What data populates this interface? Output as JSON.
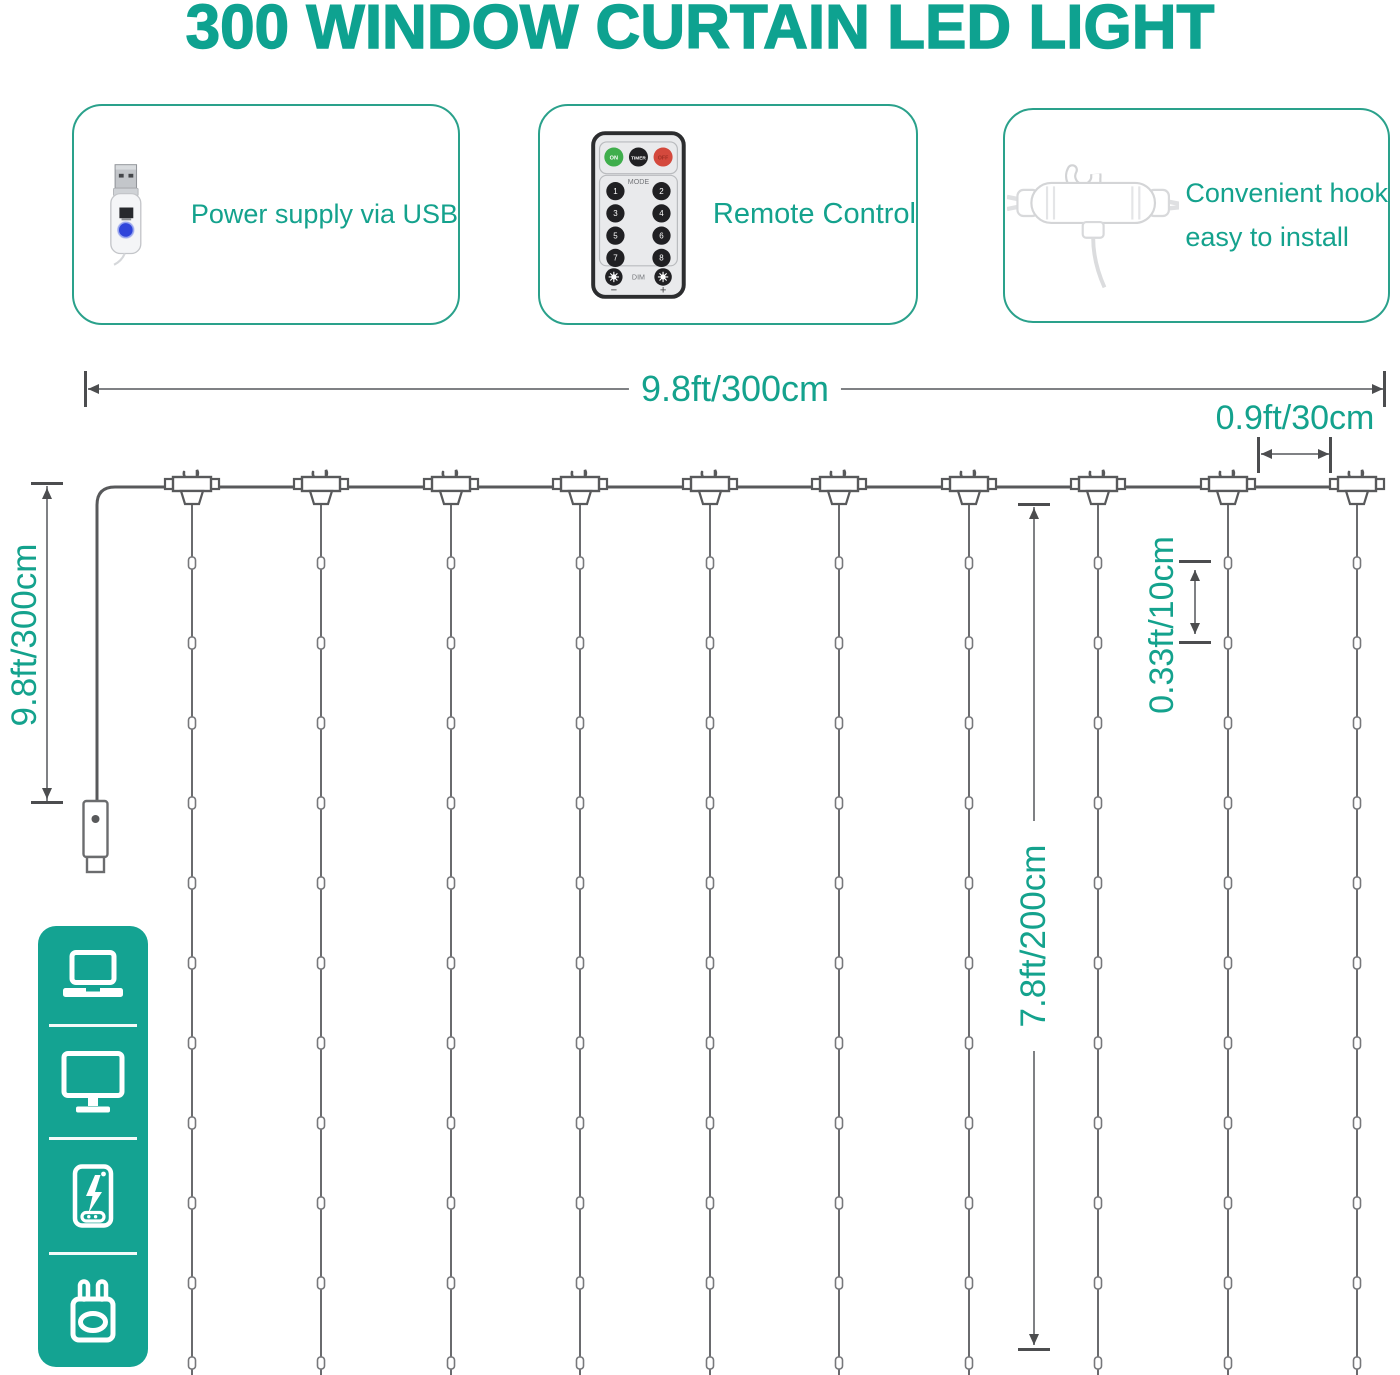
{
  "title": "300 WINDOW CURTAIN LED LIGHT",
  "theme": {
    "teal_text": "#14A28D",
    "teal_title": "#0EA290",
    "teal_border": "#2AA18B",
    "sidebar_teal": "#14A392",
    "diagram_line_gray": "#58595B"
  },
  "features": [
    {
      "icon": "usb-connector",
      "label": "Power supply via USB"
    },
    {
      "icon": "remote-control",
      "label": "Remote Control"
    },
    {
      "icon": "hanging-hook",
      "label_line1": "Convenient hook",
      "label_line2": "easy to install"
    }
  ],
  "remote": {
    "power_buttons": [
      "ON",
      "TIMER",
      "OFF"
    ],
    "mode_label": "MODE",
    "mode_buttons": [
      "1",
      "2",
      "3",
      "4",
      "5",
      "6",
      "7",
      "8"
    ],
    "dim_label": "DIM",
    "dim_minus": "−",
    "dim_plus": "+"
  },
  "dimensions": {
    "width_total": "9.8ft/300cm",
    "height_total": "9.8ft/300cm",
    "hook_spacing": "0.9ft/30cm",
    "led_spacing": "0.33ft/10cm",
    "drop_length": "7.8ft/200cm"
  },
  "diagram": {
    "strand_count": 10,
    "leds_per_strand": 11
  },
  "sidebar": {
    "icons": [
      "laptop",
      "monitor",
      "power-bank",
      "wall-plug"
    ]
  }
}
